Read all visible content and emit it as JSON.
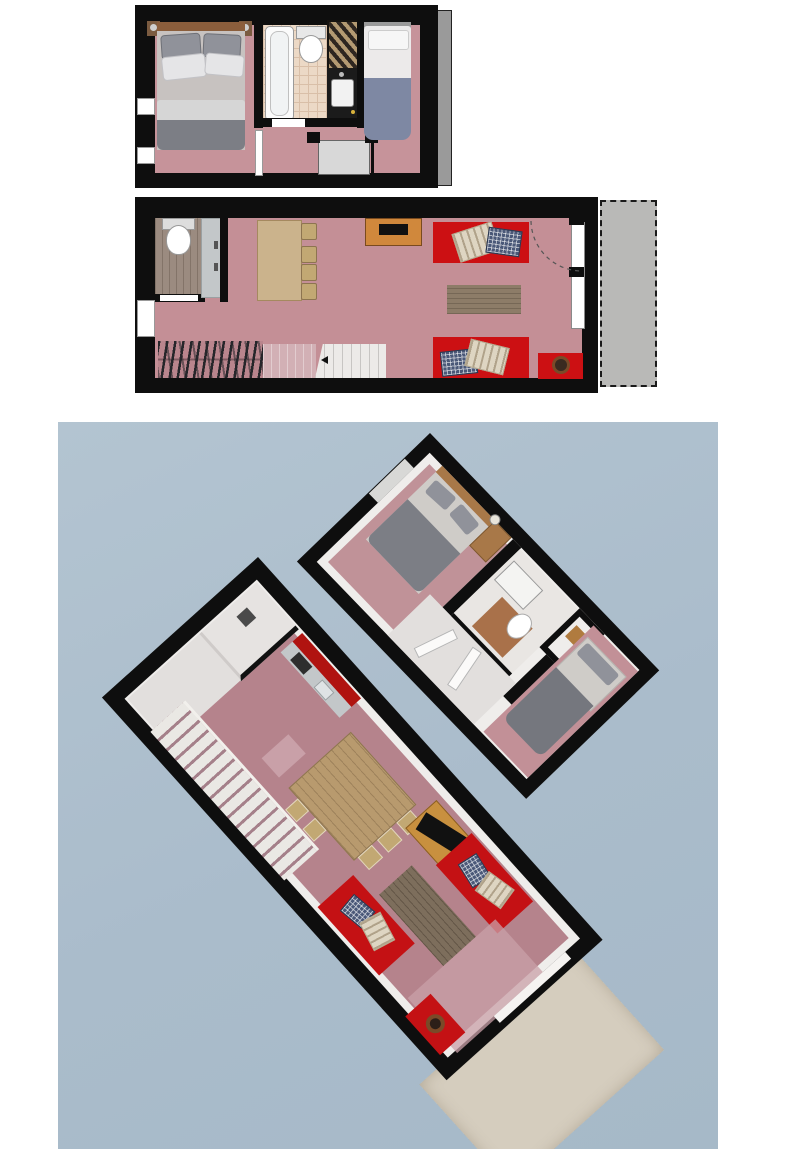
{
  "document": {
    "kind": "architectural-floor-plan-sheet",
    "text_visible": [],
    "views": [
      {
        "id": "upper-floor-2d-plan",
        "type": "2d-plan",
        "rooms": [
          "bedroom-double",
          "bathroom",
          "bedroom-single",
          "stair-landing"
        ],
        "furniture": [
          "double-bed",
          "nightstand-left",
          "nightstand-right",
          "bathtub",
          "toilet",
          "towel-shelf",
          "vanity-sink",
          "single-bed",
          "landing-platform",
          "railing-posts",
          "windows",
          "exterior-gray-strip"
        ]
      },
      {
        "id": "main-floor-2d-plan",
        "type": "2d-plan",
        "rooms": [
          "wc",
          "kitchen",
          "living-dining",
          "staircase",
          "terrace"
        ],
        "furniture": [
          "toilet",
          "kitchen-counter",
          "dining-table",
          "dining-chairs-x4",
          "tv-stand",
          "tv",
          "sofa-top",
          "sofa-bottom",
          "throw-pillows",
          "throw-blankets",
          "area-rug",
          "side-table",
          "wood-stove",
          "staircase",
          "loft-edge-hatching",
          "door-swing-arc",
          "terrace-dashed"
        ]
      },
      {
        "id": "dollhouse-3d-view",
        "type": "3d-dollhouse",
        "rooms": [
          "living-dining",
          "kitchen",
          "wc",
          "staircase",
          "bedroom-1",
          "bathroom",
          "closet",
          "bedroom-2",
          "terrace"
        ],
        "furniture": [
          "dining-table",
          "chairs",
          "tv-stand",
          "sofa-x2",
          "rug",
          "side-table-stove",
          "double-bed",
          "desk-lamp",
          "single-bed",
          "vanity-sink",
          "toilet",
          "terrace-deck"
        ]
      }
    ]
  },
  "palette": {
    "wall": "#0e0e0e",
    "paper": "#ffffff",
    "blue-bg": "#aabccb",
    "pink-2d": "#c6939a",
    "pink-main": "#c48f96",
    "pink-3d": "#b5838c",
    "pink-3d-bed1": "#c09298",
    "pink-3d-bed2": "#c29097",
    "pink-patch": "#c9a0a8",
    "red": "#cc1013",
    "red-3d": "#c41114",
    "red-kitchen": "#b01310",
    "rug-2d": "#8d7c68",
    "rug-3d": "#7d6e5c",
    "table-2d": "#cbb38c",
    "table-3d": "#b89a6e",
    "chair": "#c2a873",
    "tv-stand": "#d0883c",
    "tv-stand-3d": "#c8903f",
    "wc-wood": "#9b8b80",
    "counter": "#c3c7c9",
    "tile": "#ecd9c6",
    "tile-line": "#d9bfa8",
    "stairs": "#eceae8",
    "stair-fade": "#d2b0b5",
    "terrace-2d": "#b9b9b7",
    "terrace-3d": "#d5cdbe",
    "landing": "#d8d8d8",
    "gray-strip": "#9a9a9a",
    "white-3d": "#efedeb",
    "hall-3d": "#e2dfdd",
    "mattress": "#cfccc8",
    "blanket": "#7c7e85",
    "pillow": "#90929a",
    "duvet": "#e5e5e7",
    "bed-blue": "#7e88a3",
    "headboard": "#8b5e3c",
    "headboard-3d": "#a87848",
    "vanity": "#1b1b1b",
    "shelf-dark": "#2e2620",
    "towel": "#b49a72",
    "stove-ring": "#7a4a28",
    "navy": "#4a5878",
    "cream": "#ded5c2",
    "wood-patch": "#a9714a",
    "closet-wood": "#b07b3f",
    "hatch-bg": "#b9858d",
    "hatch-line": "#26262a"
  }
}
